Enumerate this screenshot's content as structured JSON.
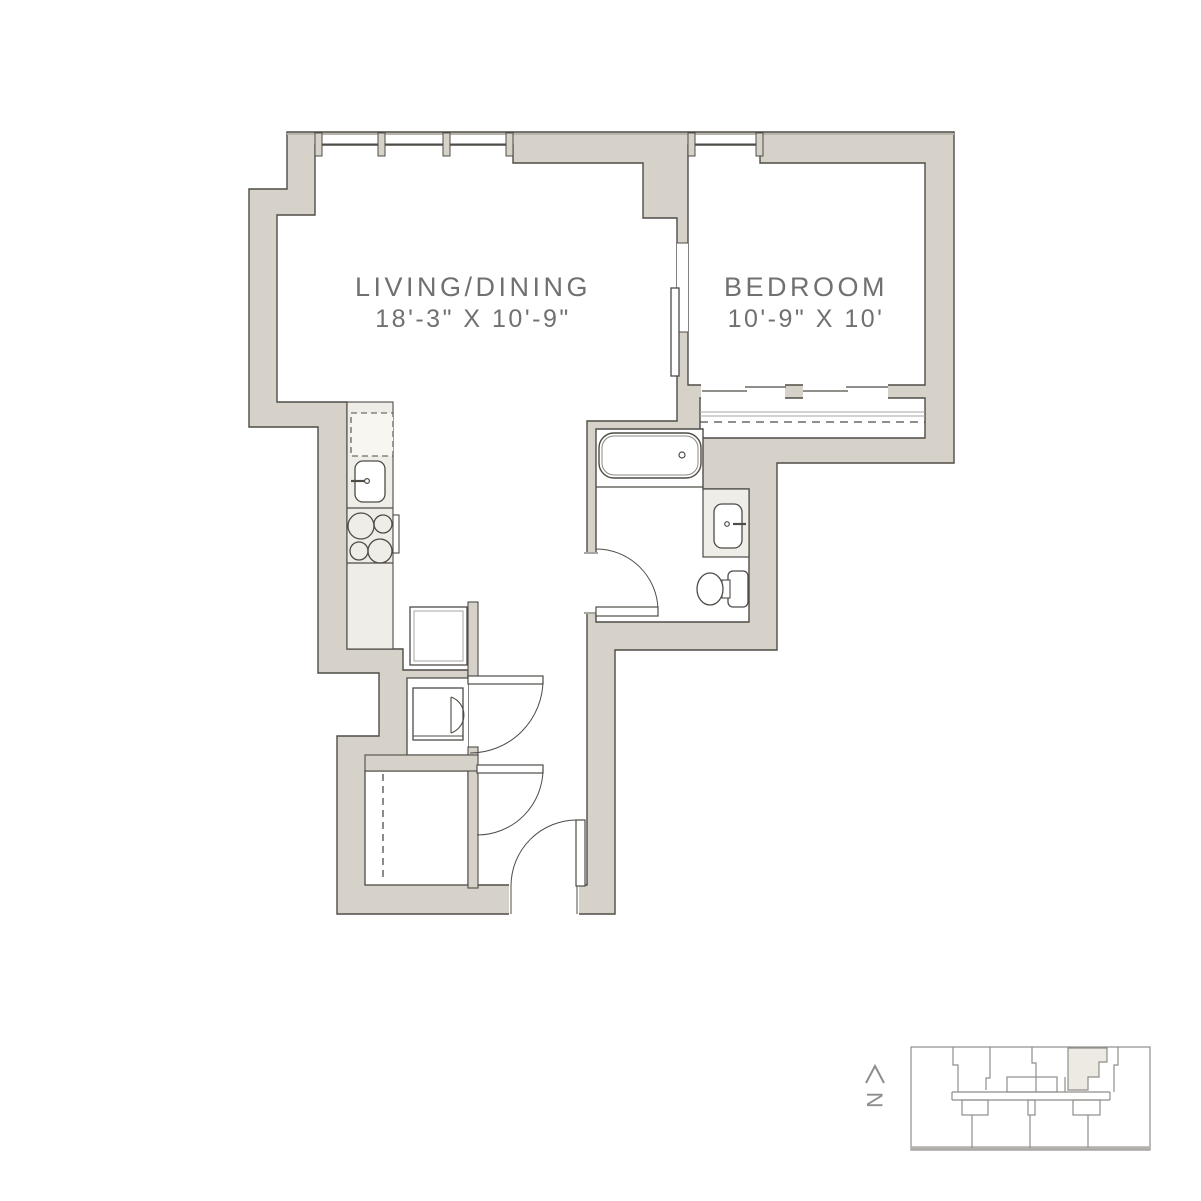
{
  "floor_plan": {
    "rooms": {
      "living_dining": {
        "name": "LIVING/DINING",
        "dimensions": "18'-3\" X 10'-9\""
      },
      "bedroom": {
        "name": "BEDROOM",
        "dimensions": "10'-9\" X 10'"
      }
    },
    "north_indicator": {
      "label": "N"
    },
    "fixtures": [
      "bathtub",
      "vanity-sink",
      "toilet",
      "kitchen-sink",
      "stove-burners",
      "oven-handle",
      "refrigerator",
      "washer-dryer",
      "upper-cabinet-dashed",
      "closet-rod-dashed",
      "closet-shelf",
      "entry-door",
      "bathroom-door",
      "closet-doors",
      "bedroom-sliding-door",
      "closet-sliding-doors",
      "windows",
      "key-plan",
      "north-arrow"
    ],
    "colors": {
      "wall_fill": "#d6d2c9",
      "outline": "#4f4c47",
      "counter_fill": "#efede7",
      "label_text": "#707070",
      "window_head_line": "#b7b4ac",
      "keyplan_line": "#908e8a",
      "keyplan_highlight": "#eceae2"
    }
  }
}
